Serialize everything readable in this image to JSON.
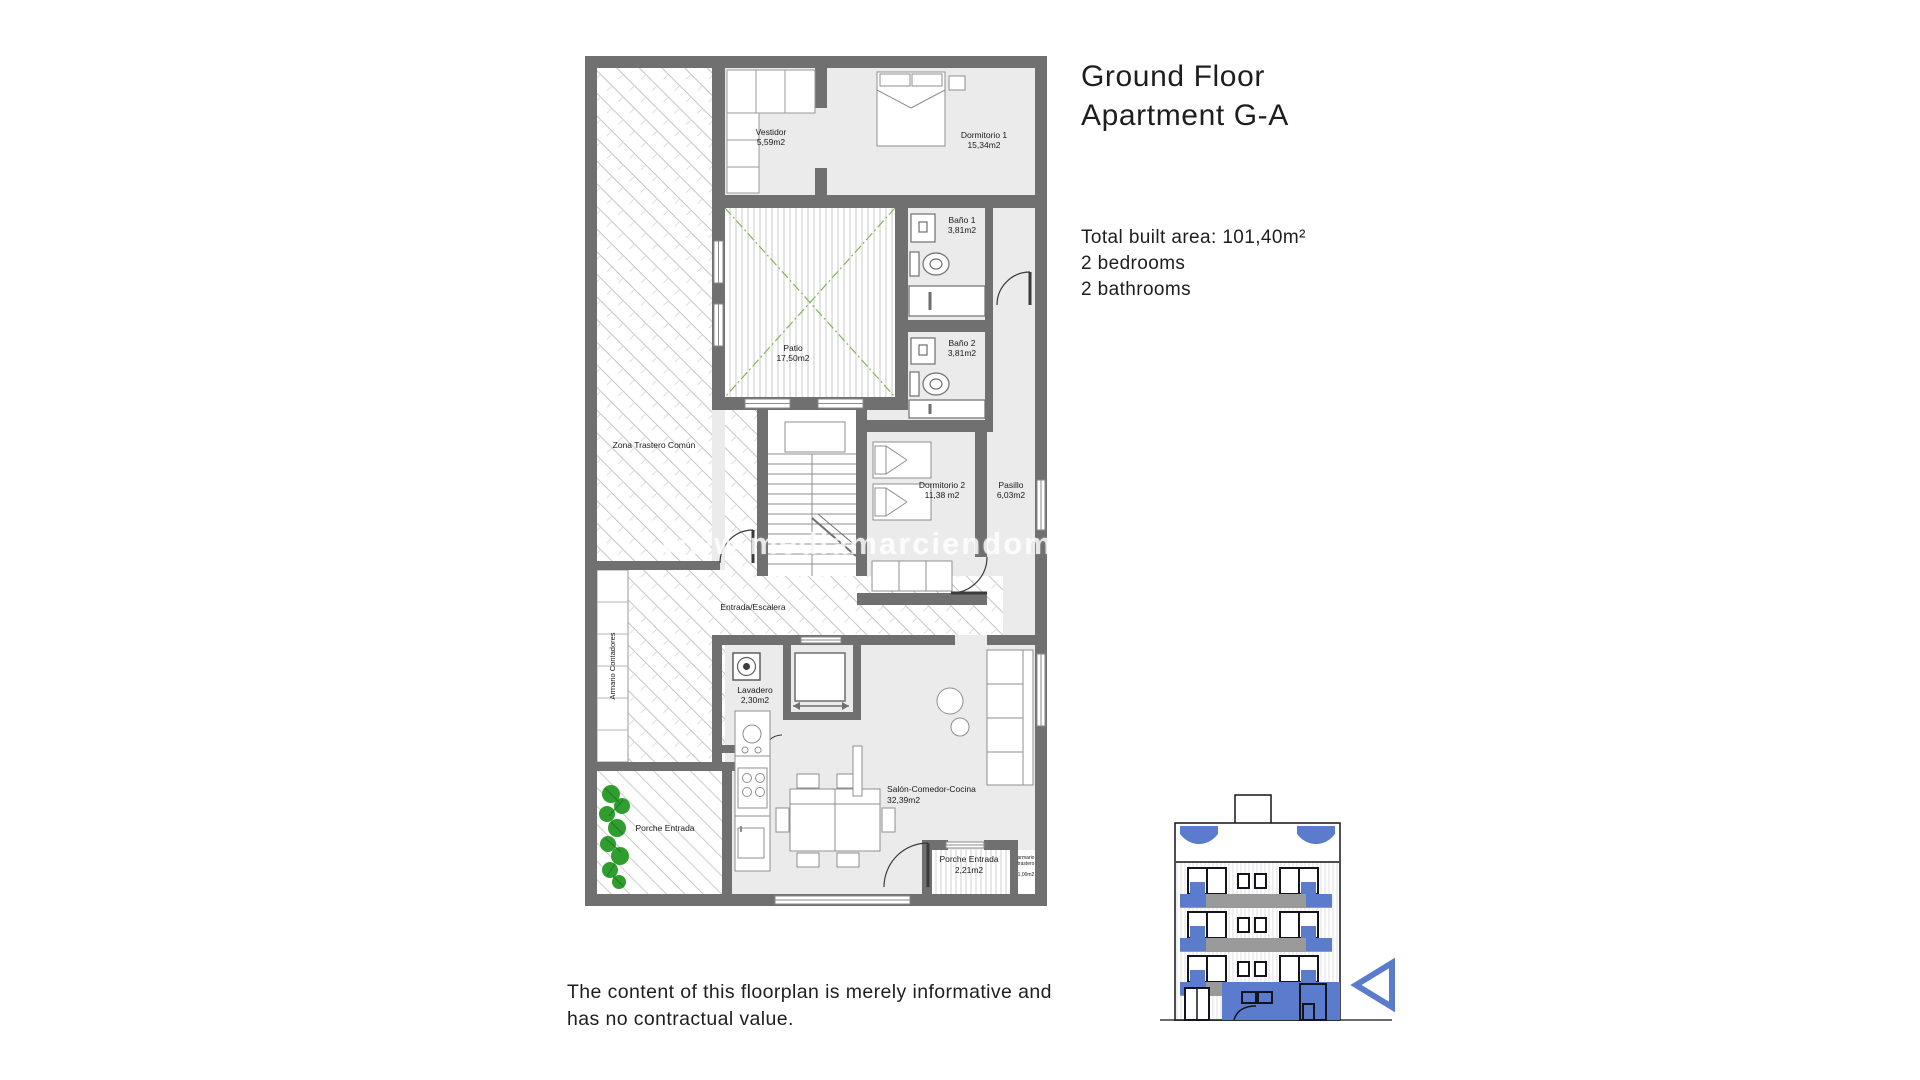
{
  "page": {
    "title_line1": "Ground Floor",
    "title_line2": "Apartment G-A",
    "details_line1": "Total built area: 101,40m²",
    "details_line2": "2 bedrooms",
    "details_line3": "2 bathrooms",
    "disclaimer_line1": "The content of this floorplan is merely informative and",
    "disclaimer_line2": "has no contractual value.",
    "watermark": "www.mediamarciendom"
  },
  "plan": {
    "rooms": [
      {
        "name": "Vestidor",
        "area": "5,59m2"
      },
      {
        "name": "Dormitorio 1",
        "area": "15,34m2"
      },
      {
        "name": "Baño 1",
        "area": "3,81m2"
      },
      {
        "name": "Baño 2",
        "area": "3,81m2"
      },
      {
        "name": "Patio",
        "area": "17,50m2"
      },
      {
        "name": "Zona Trastero Común",
        "area": ""
      },
      {
        "name": "Dormitorio 2",
        "area": "11,38 m2"
      },
      {
        "name": "Pasillo",
        "area": "6,03m2"
      },
      {
        "name": "Entrada/Escalera",
        "area": ""
      },
      {
        "name": "Armario Contadores",
        "area": ""
      },
      {
        "name": "Lavadero",
        "area": "2,30m2"
      },
      {
        "name": "Salón-Comedor-Cocina",
        "area": "32,39m2"
      },
      {
        "name": "Porche Entrada",
        "area": ""
      },
      {
        "name": "Porche Entrada",
        "area": "2,21m2"
      },
      {
        "name": "armario",
        "name2": "trastero",
        "area": "1,00m2"
      }
    ],
    "colors": {
      "wall_gray": "#707070",
      "floor_gray": "#ebebeb",
      "hatch_gray": "#c5c5c5",
      "patio_green": "#86b65a",
      "plant_green": "#2f9e2f"
    }
  },
  "inset": {
    "highlight_blue": "#5b7ccc",
    "outline_dark": "#14141e",
    "balcony_gray": "#9a9a9a"
  }
}
